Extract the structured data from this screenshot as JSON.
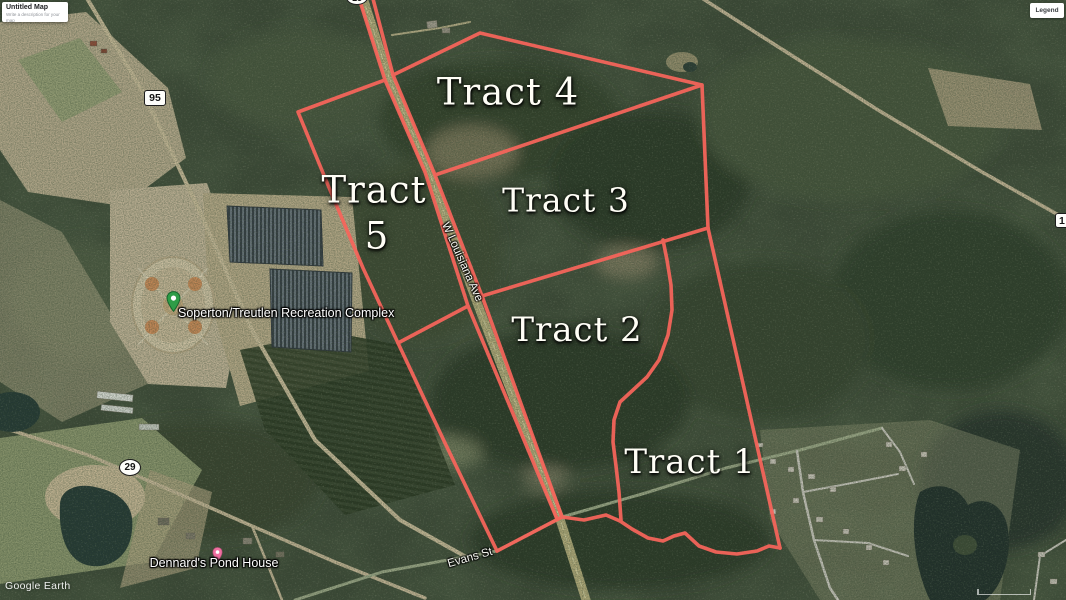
{
  "app": {
    "map_card": {
      "title": "Untitled Map",
      "subtitle": "Write a description for your map"
    },
    "legend_button": "Legend",
    "watermark": "Google Earth"
  },
  "tract_labels": {
    "tract1": "Tract 1",
    "tract2": "Tract 2",
    "tract3": "Tract 3",
    "tract4": "Tract 4",
    "tract5_word": "Tract",
    "tract5_number": "5"
  },
  "road_labels": {
    "w_louisiana_ave": "W Louisiana Ave",
    "evans_st": "Evans St"
  },
  "road_shields": {
    "route_95": "95",
    "route_29": "29",
    "route_top_partial": "15",
    "route_right_partial": "1"
  },
  "places": {
    "recreation_complex": "Soperton/Treutlen Recreation Complex",
    "dennards_pond_house": "Dennard's Pond House"
  },
  "colors": {
    "tract_boundary": "#f8655b",
    "recreation_pin": "#2e9d47",
    "dennards_pin": "#f06fa0"
  }
}
